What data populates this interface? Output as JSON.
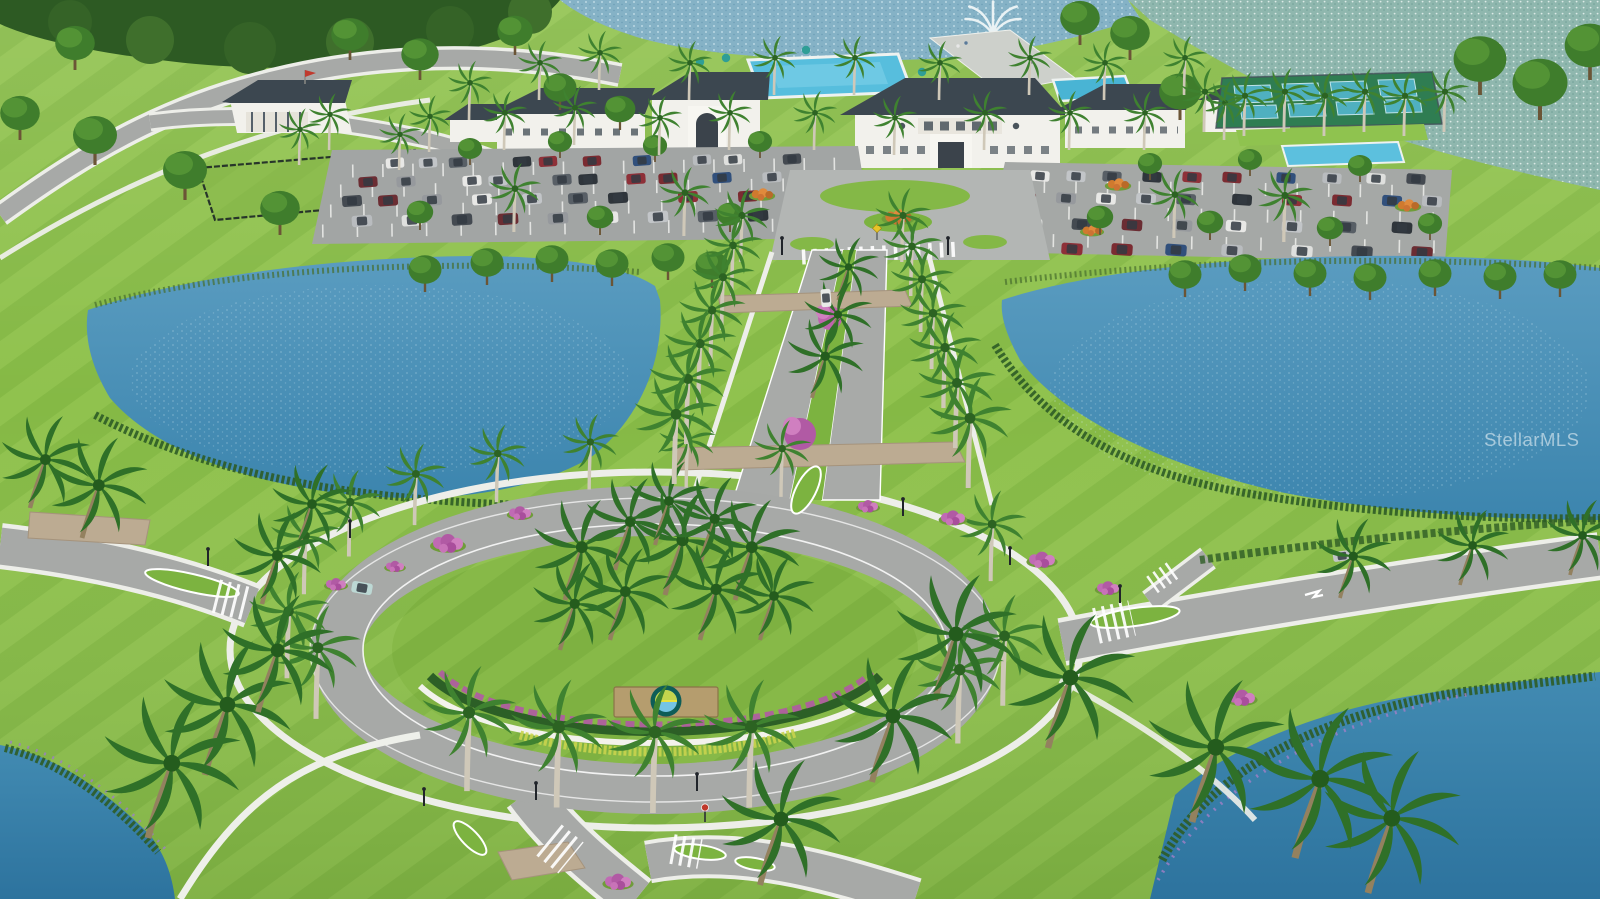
{
  "watermark": {
    "text": "StellarMLS"
  },
  "scene": {
    "type": "aerial-3d-rendering",
    "subject": "master-planned community entrance with roundabout, palm-lined boulevard, lakes, clubhouse campus, parking and pickleball courts"
  },
  "monument_sign": {
    "shape": "bronze plaque with circular sun-and-water logo"
  },
  "colors": {
    "grass": "#8cbd4a",
    "grass_dark": "#6da036",
    "forest": "#2d5a23",
    "water_main": "#4a90b6",
    "water_deep": "#2f78a3",
    "water_shimmer": "#8fb7ae",
    "road": "#a7a9a7",
    "sidewalk": "#edeee9",
    "paver": "#bcab92",
    "roof": "#3c4750",
    "wall_white": "#f2f1ec",
    "pool": "#57bedd",
    "flower_pink": "#bf64ae",
    "flower_orange": "#d07a2e",
    "flower_purple": "#9b7fc4",
    "monument_tan": "#b59d6e",
    "logo_teal": "#0e5d57",
    "logo_leaf": "#c3d44d",
    "logo_water": "#74c4e4",
    "car_palette": [
      "#e8e8e6",
      "#c2c5c8",
      "#585f66",
      "#2f353b",
      "#8e3038",
      "#7b2b31",
      "#31507c",
      "#b9bcbf",
      "#dfe0de",
      "#444a51",
      "#6b2d33",
      "#96999d"
    ]
  }
}
